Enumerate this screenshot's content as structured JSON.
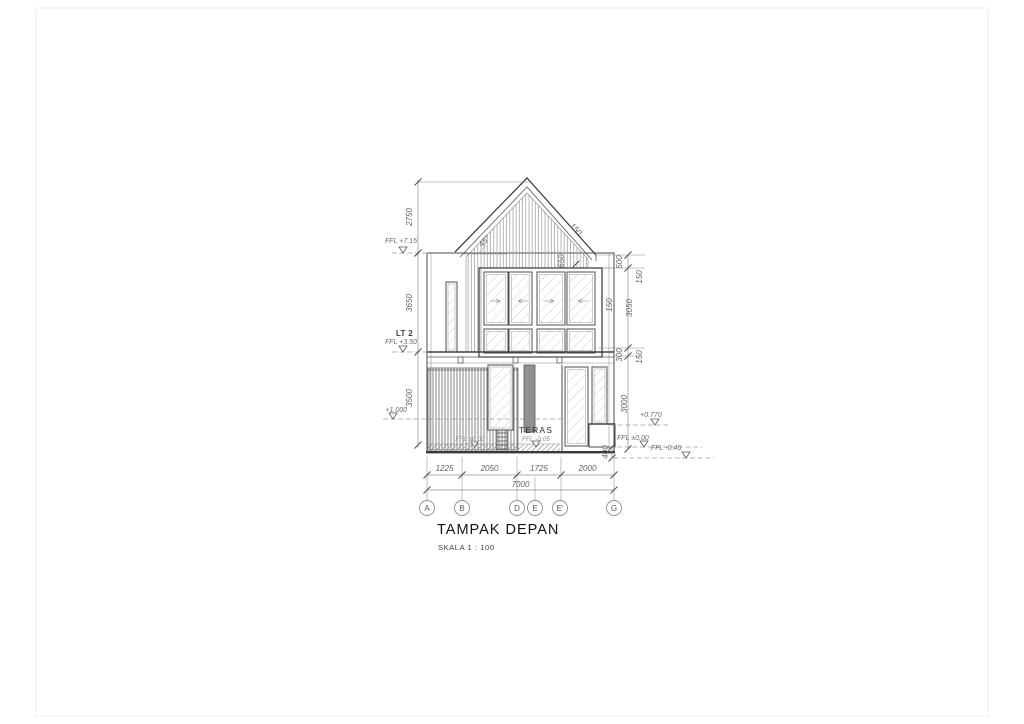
{
  "title_block": {
    "title": "TAMPAK DEPAN",
    "scale": "SKALA 1 : 100"
  },
  "grid_bubbles": [
    "A",
    "B",
    "D",
    "E",
    "E'",
    "G"
  ],
  "dims": {
    "bottom": [
      "1225",
      "2050",
      "1725",
      "2000"
    ],
    "bottom_total": "7000",
    "left_roof": "2750",
    "left_upper": "3650",
    "left_lower": "3500",
    "right_parapet": "500",
    "right_cap": "150",
    "right_upper": "3050",
    "right_wall": "150",
    "right_beam": "300",
    "right_band": "150",
    "right_lower": "3000",
    "right_base": "400",
    "roof_overhang": "650",
    "roof_thickness": "150",
    "roof_angle": "45°"
  },
  "levels": {
    "eaves": "FFL +7.15",
    "floor2_tag": "LT 2",
    "floor2": "FFL +3.50",
    "fence": "+1.000",
    "ground_hidden": "FFL ±0.00",
    "teras_tag": "TERAS",
    "teras": "FFL -0.05",
    "planter": "+0.770",
    "ground": "FFL ±0.00",
    "yard": "FFL -0.40"
  },
  "colors": {
    "line": "#4a4a4a",
    "dim_text": "#5f5f5f",
    "title": "#141414"
  }
}
